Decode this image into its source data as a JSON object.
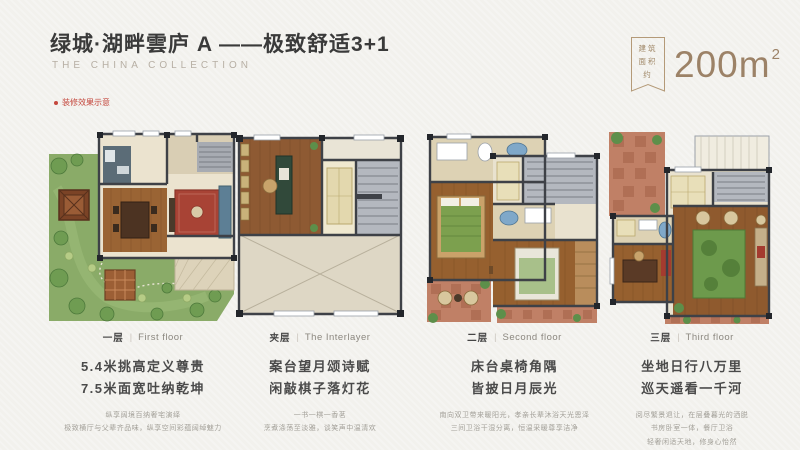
{
  "header": {
    "title": "绿城·湖畔雲庐 A ——极致舒适3+1",
    "subtitle": "THE CHINA COLLECTION",
    "disclaimer": "装修效果示意",
    "area_badge_label": "建筑面积约",
    "area_value": "200m",
    "area_sup": "2"
  },
  "colors": {
    "background": "#f2f1ed",
    "accent_tan": "#9c8267",
    "accent_red": "#c4473d",
    "garden_green": "#8aab68",
    "wood_floor": "#96602f",
    "wall": "#3e4147",
    "stair_gray": "#b4b8bf",
    "terrace_red": "#c08066",
    "rug_red": "#a84335",
    "rug_green": "#6d9a4c"
  },
  "floors": [
    {
      "cn": "一层",
      "en": "First floor",
      "headlines": [
        "5.4米挑高定义尊贵",
        "7.5米面宽吐纳乾坤"
      ],
      "captions": [
        "纵享阔境百纳奢宅演绎",
        "极致横厅与父辈齐品味，纵享空间彩蕴阔绰魅力"
      ]
    },
    {
      "cn": "夹层",
      "en": "The Interlayer",
      "headlines": [
        "案台望月颂诗赋",
        "闲敲棋子落灯花"
      ],
      "captions": [
        "一书一棋一香茗",
        "烹煮涤荡至淡雅，谈笑声中温清欢"
      ]
    },
    {
      "cn": "二层",
      "en": "Second floor",
      "headlines": [
        "床台桌椅角隅",
        "皆披日月辰光"
      ],
      "captions": [
        "南向双卫带来暖阳光，孝亲长辈沐浴天光恩泽",
        "三间卫浴干湿分离，恒温采暖尊享洁净"
      ]
    },
    {
      "cn": "三层",
      "en": "Third floor",
      "headlines": [
        "坐地日行八万里",
        "巡天遥看一千河"
      ],
      "captions": [
        "阅尽繁景退让，在层叠暮光的洒脱",
        "书房卧室一体，餐厅卫浴",
        "轻奢闲适天地，修身心怡然"
      ]
    }
  ]
}
